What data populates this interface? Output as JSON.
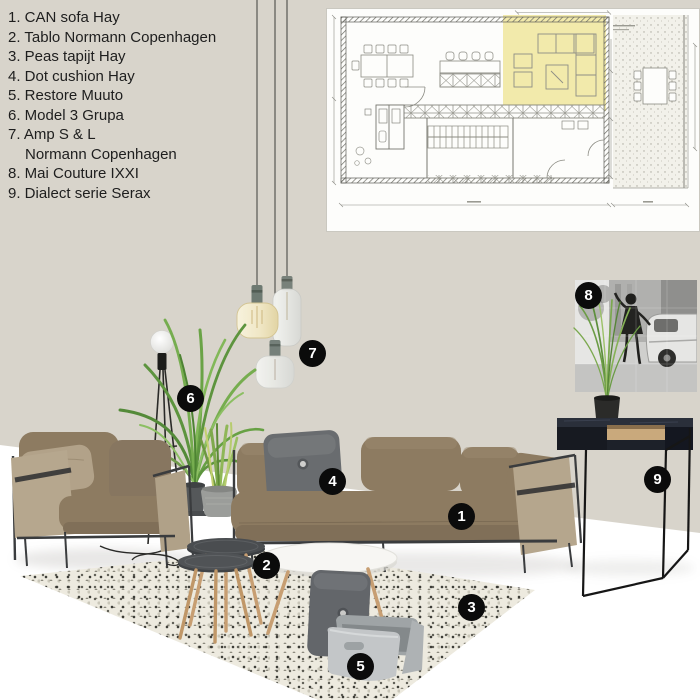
{
  "legend": {
    "lines": [
      {
        "text": "1. CAN sofa Hay",
        "indent": false
      },
      {
        "text": "2. Tablo Normann Copenhagen",
        "indent": false
      },
      {
        "text": "3. Peas tapijt Hay",
        "indent": false
      },
      {
        "text": "4. Dot cushion Hay",
        "indent": false
      },
      {
        "text": "5. Restore Muuto",
        "indent": false
      },
      {
        "text": "6. Model 3 Grupa",
        "indent": false
      },
      {
        "text": "7. Amp S & L",
        "indent": false
      },
      {
        "text": "Normann Copenhagen",
        "indent": true
      },
      {
        "text": "8. Mai Couture IXXI",
        "indent": false
      },
      {
        "text": "9. Dialect serie Serax",
        "indent": false
      }
    ]
  },
  "badges": [
    {
      "n": "1"
    },
    {
      "n": "2"
    },
    {
      "n": "3"
    },
    {
      "n": "4"
    },
    {
      "n": "5"
    },
    {
      "n": "6"
    },
    {
      "n": "7"
    },
    {
      "n": "8"
    },
    {
      "n": "9"
    }
  ],
  "floorplan": {
    "highlighted_zone": "living area",
    "highlight_color": "#f1e9a6"
  },
  "colors": {
    "wall": "#d8d4cb",
    "floor": "#fbfaf7",
    "sofa_taupe": "#8d7b61",
    "canvas_side": "#b6a78e",
    "metal_frame": "#3a3c3e",
    "cushion_grey": "#696c6f",
    "rug_cream": "#edeadf",
    "table_dark_grey": "#44474a",
    "wood_leg": "#c79e72",
    "basket_felt": "#c3c6c8",
    "console_dark": "#1d212a",
    "badge_black": "#0b0b0b"
  }
}
